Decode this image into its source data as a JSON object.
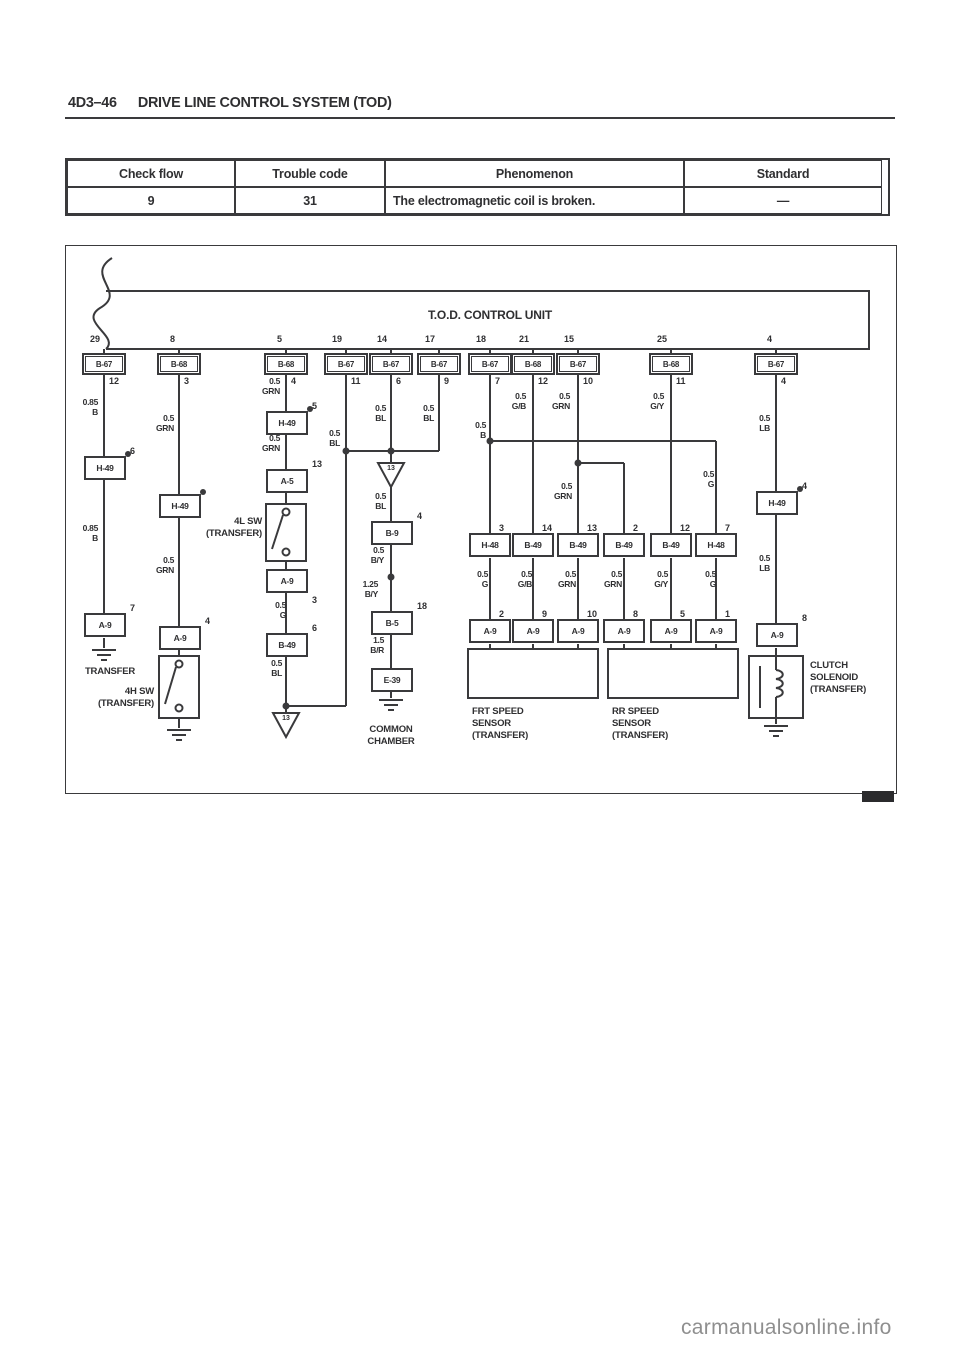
{
  "page": {
    "header_number": "4D3–46",
    "header_title": "DRIVE LINE CONTROL SYSTEM (TOD)",
    "watermark": "carmanualsonline.info"
  },
  "table": {
    "headers": [
      "Check flow",
      "Trouble code",
      "Phenomenon",
      "Standard"
    ],
    "row": {
      "check_flow": "9",
      "trouble_code": "31",
      "phenomenon": "The electromagnetic coil is broken.",
      "standard": "—"
    }
  },
  "diagram": {
    "title": "T.O.D. CONTROL UNIT",
    "top_pins": [
      {
        "pin": "29",
        "connector": "B-67",
        "below": "12"
      },
      {
        "pin": "8",
        "connector": "B-68",
        "below": "3"
      },
      {
        "pin": "5",
        "connector": "B-68",
        "below": "4"
      },
      {
        "pin": "19",
        "connector": "B-67",
        "below": "11"
      },
      {
        "pin": "14",
        "connector": "B-67",
        "below": "6"
      },
      {
        "pin": "17",
        "connector": "B-67",
        "below": "9"
      },
      {
        "pin": "18",
        "connector": "B-67",
        "below": "7"
      },
      {
        "pin": "21",
        "connector": "B-68",
        "below": "12"
      },
      {
        "pin": "15",
        "connector": "B-67",
        "below": "10"
      },
      {
        "pin": "25",
        "connector": "B-68",
        "below": "11"
      },
      {
        "pin": "4",
        "connector": "B-67",
        "below": "4"
      }
    ],
    "boxes": {
      "c1_h49": {
        "label": "H-49",
        "pin": "6"
      },
      "c1_a9": {
        "label": "A-9",
        "pin": "7"
      },
      "c2_h49": {
        "label": "H-49",
        "pin": ""
      },
      "c2_a9": {
        "label": "A-9",
        "pin": "4"
      },
      "c3_h49": {
        "label": "H-49",
        "pin": "5"
      },
      "c3_a5": {
        "label": "A-5",
        "pin": "13"
      },
      "c3_a9": {
        "label": "A-9",
        "pin": "3"
      },
      "c3_b49": {
        "label": "B-49",
        "pin": "6"
      },
      "mid_b9": {
        "label": "B-9",
        "pin": "4"
      },
      "mid_b5": {
        "label": "B-5",
        "pin": "18"
      },
      "mid_e39": {
        "label": "E-39",
        "pin": ""
      },
      "clutch_h49": {
        "label": "H-49",
        "pin": "4"
      },
      "clutch_a9": {
        "label": "A-9",
        "pin": "8"
      },
      "sensor_top": [
        {
          "label": "H-48",
          "pin": "3"
        },
        {
          "label": "B-49",
          "pin": "14"
        },
        {
          "label": "B-49",
          "pin": "13"
        },
        {
          "label": "B-49",
          "pin": "2"
        },
        {
          "label": "B-49",
          "pin": "12"
        },
        {
          "label": "H-48",
          "pin": "7"
        }
      ],
      "sensor_a9": [
        {
          "label": "A-9",
          "pin": "2"
        },
        {
          "label": "A-9",
          "pin": "9"
        },
        {
          "label": "A-9",
          "pin": "10"
        },
        {
          "label": "A-9",
          "pin": "8"
        },
        {
          "label": "A-9",
          "pin": "5"
        },
        {
          "label": "A-9",
          "pin": "1"
        }
      ]
    },
    "wire_labels": [
      "0.85\nB",
      "0.85\nB",
      "0.5\nGRN",
      "0.5\nGRN",
      "0.5\nGRN",
      "0.5\nGRN",
      "0.5\nG",
      "0.5\nBL",
      "0.5\nBL",
      "0.5\nBL",
      "0.5\nBL",
      "0.5\nB/Y",
      "1.25\nB/Y",
      "1.5\nB/R",
      "0.5\nBL",
      "0.5\nB",
      "0.5\nG/B",
      "0.5\nGRN",
      "0.5\nG/Y",
      "0.5\nG",
      "0.5\nGRN",
      "0.5\nG",
      "0.5\nG/B",
      "0.5\nGRN",
      "0.5\nGRN",
      "0.5\nG/Y",
      "0.5\nG",
      "0.5\nLB",
      "0.5\nLB"
    ],
    "labels": {
      "transfer": "TRANSFER",
      "sw4h": "4H SW\n(TRANSFER)",
      "sw4l": "4L SW\n(TRANSFER)",
      "common_chamber": "COMMON\nCHAMBER",
      "frt_sensor": "FRT SPEED\nSENSOR\n(TRANSFER)",
      "rr_sensor": "RR SPEED\nSENSOR\n(TRANSFER)",
      "clutch_solenoid": "CLUTCH\nSOLENOID\n(TRANSFER)",
      "arrow_id": "13"
    }
  }
}
